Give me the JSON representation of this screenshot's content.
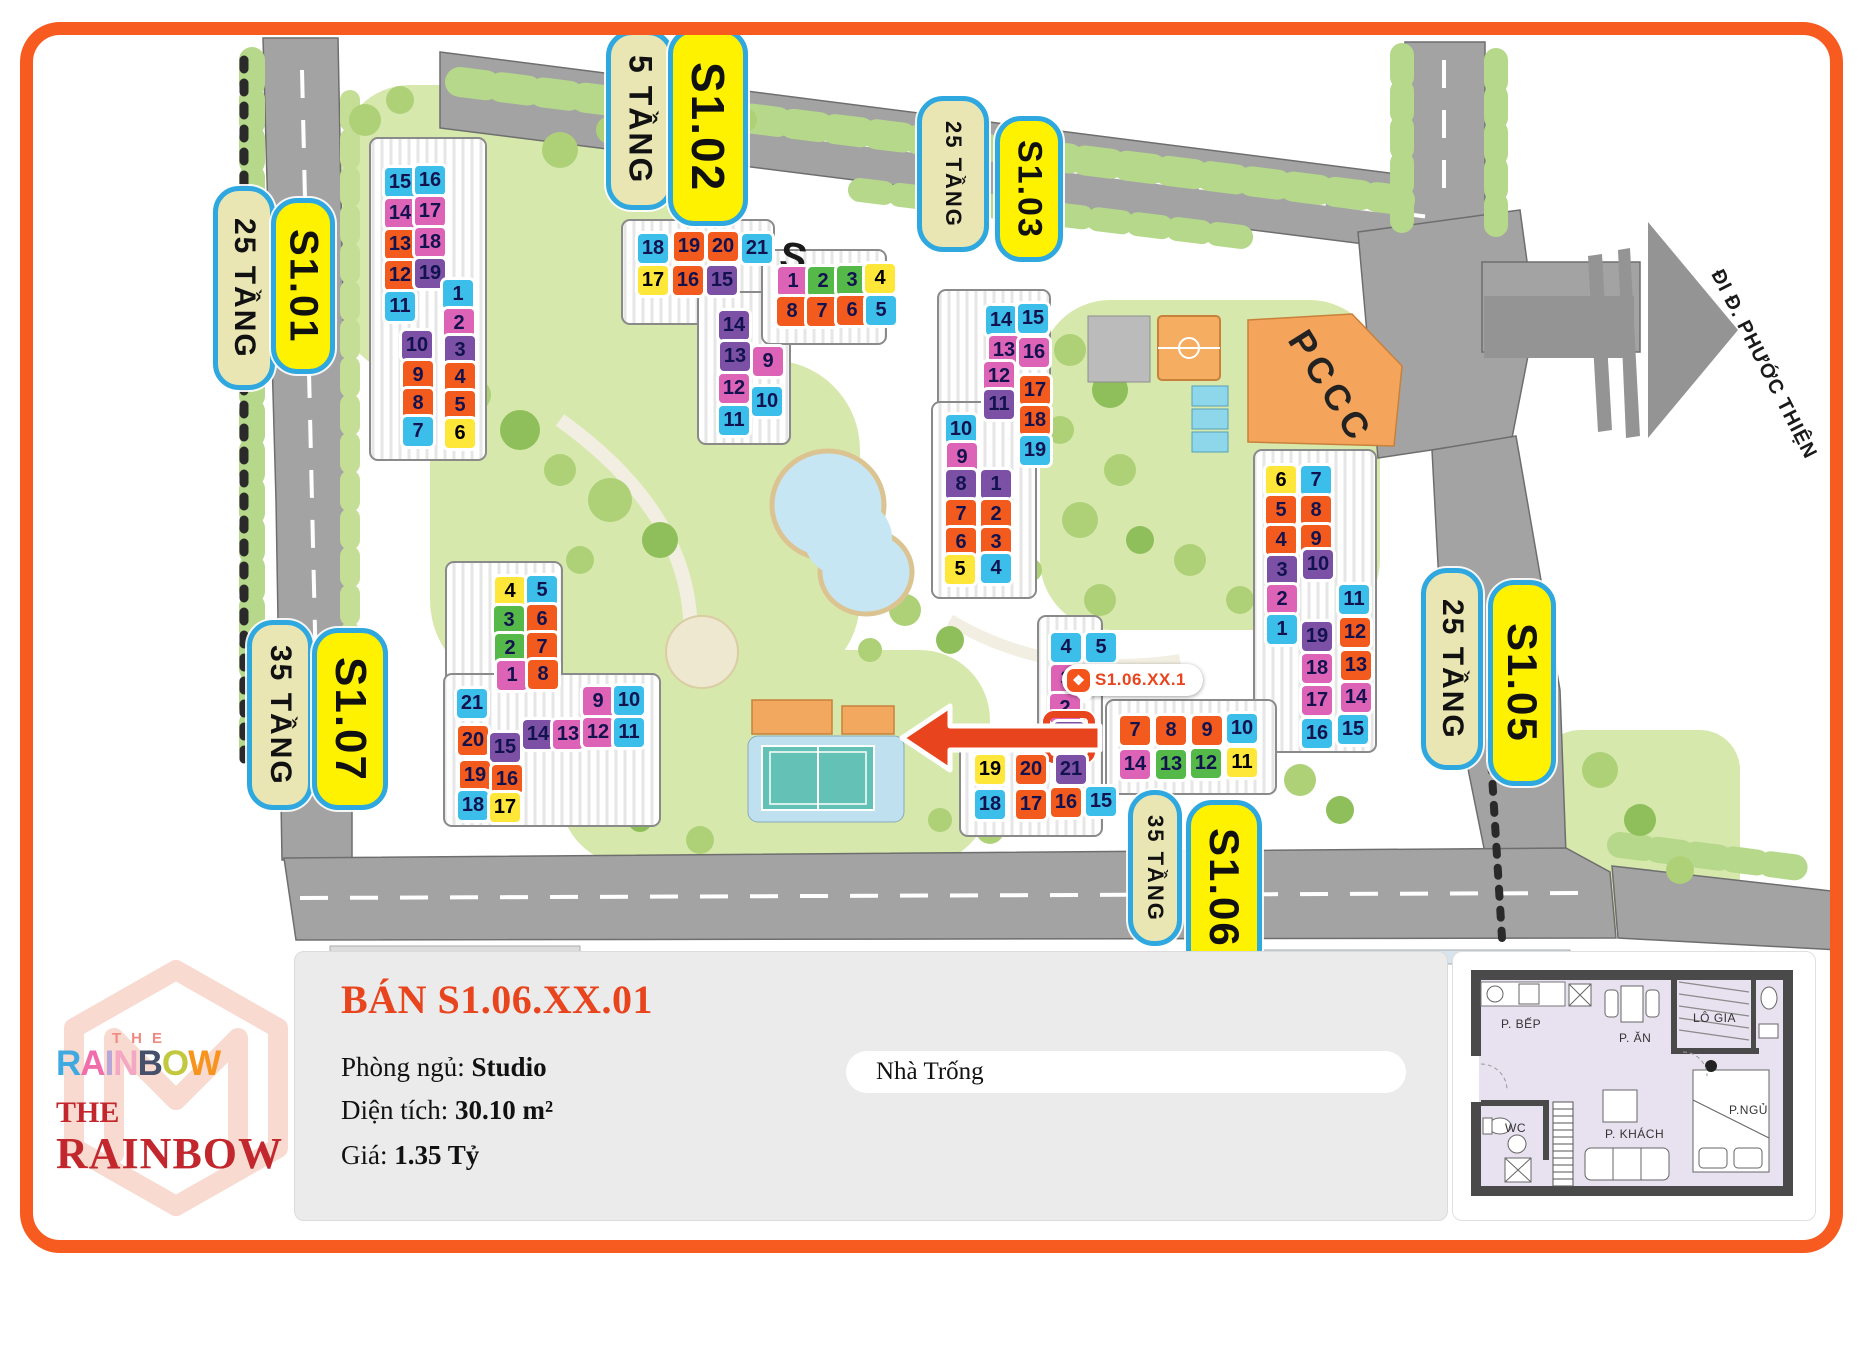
{
  "map": {
    "pccc_label": "PCCC",
    "road_sign": "ĐI Đ. PHƯỚC THIỆN",
    "stray_letter": "S",
    "tooltip": {
      "unit_code": "S1.06.XX.1",
      "icon": "diamond-logo"
    },
    "palette": {
      "cyan": "#3BBEEA",
      "magenta": "#DC63B6",
      "purple": "#7B50A5",
      "orange": "#F25A1E",
      "yellow": "#FFE73A",
      "green": "#54B948"
    },
    "labels": [
      {
        "name": "25tang-s101",
        "text": "25 TẦNG",
        "type": "tan",
        "x": 213,
        "y": 186,
        "w": 52,
        "h": 194,
        "fs": 30
      },
      {
        "name": "s101",
        "text": "S1.01",
        "type": "yel",
        "x": 271,
        "y": 198,
        "w": 54,
        "h": 166,
        "fs": 40
      },
      {
        "name": "5tang-s102",
        "text": "5 TẦNG",
        "type": "tan",
        "x": 606,
        "y": 30,
        "w": 58,
        "h": 170,
        "fs": 32
      },
      {
        "name": "s102",
        "text": "S1.02",
        "type": "yel",
        "x": 668,
        "y": 28,
        "w": 70,
        "h": 188,
        "fs": 46
      },
      {
        "name": "25tang-s103",
        "text": "25 TẦNG",
        "type": "tan",
        "x": 917,
        "y": 96,
        "w": 62,
        "h": 146,
        "fs": 22
      },
      {
        "name": "s103",
        "text": "S1.03",
        "type": "yel",
        "x": 995,
        "y": 116,
        "w": 58,
        "h": 136,
        "fs": 34
      },
      {
        "name": "25tang-s105",
        "text": "25 TẦNG",
        "type": "tan",
        "x": 1421,
        "y": 568,
        "w": 52,
        "h": 192,
        "fs": 30
      },
      {
        "name": "s105",
        "text": "S1.05",
        "type": "yel",
        "x": 1488,
        "y": 580,
        "w": 58,
        "h": 196,
        "fs": 42
      },
      {
        "name": "35tang-s107",
        "text": "35 TẦNG",
        "type": "tan",
        "x": 247,
        "y": 620,
        "w": 56,
        "h": 180,
        "fs": 30
      },
      {
        "name": "s107",
        "text": "S1.07",
        "type": "yel",
        "x": 312,
        "y": 628,
        "w": 66,
        "h": 172,
        "fs": 44
      },
      {
        "name": "35tang-s106",
        "text": "35 TẦNG",
        "type": "tan",
        "x": 1128,
        "y": 790,
        "w": 44,
        "h": 146,
        "fs": 22
      },
      {
        "name": "s106",
        "text": "S1.06",
        "type": "yel",
        "x": 1186,
        "y": 800,
        "w": 66,
        "h": 166,
        "fs": 42
      }
    ],
    "buildings": [
      {
        "id": "S1.01",
        "units": [
          {
            "n": "15",
            "c": "cyan",
            "x": 385,
            "y": 168
          },
          {
            "n": "16",
            "c": "cyan",
            "x": 415,
            "y": 166
          },
          {
            "n": "14",
            "c": "magenta",
            "x": 385,
            "y": 199
          },
          {
            "n": "17",
            "c": "magenta",
            "x": 415,
            "y": 197
          },
          {
            "n": "13",
            "c": "orange",
            "x": 385,
            "y": 230
          },
          {
            "n": "18",
            "c": "magenta",
            "x": 415,
            "y": 228
          },
          {
            "n": "12",
            "c": "orange",
            "x": 385,
            "y": 261
          },
          {
            "n": "19",
            "c": "purple",
            "x": 415,
            "y": 259
          },
          {
            "n": "11",
            "c": "cyan",
            "x": 385,
            "y": 292
          },
          {
            "n": "1",
            "c": "cyan",
            "x": 443,
            "y": 280
          },
          {
            "n": "2",
            "c": "magenta",
            "x": 444,
            "y": 309
          },
          {
            "n": "10",
            "c": "purple",
            "x": 402,
            "y": 331
          },
          {
            "n": "3",
            "c": "purple",
            "x": 445,
            "y": 336
          },
          {
            "n": "9",
            "c": "orange",
            "x": 403,
            "y": 361
          },
          {
            "n": "4",
            "c": "orange",
            "x": 445,
            "y": 363
          },
          {
            "n": "8",
            "c": "orange",
            "x": 403,
            "y": 389
          },
          {
            "n": "5",
            "c": "orange",
            "x": 445,
            "y": 391
          },
          {
            "n": "7",
            "c": "cyan",
            "x": 403,
            "y": 417
          },
          {
            "n": "6",
            "c": "yellow",
            "x": 445,
            "y": 419
          }
        ]
      },
      {
        "id": "S1.02",
        "units": [
          {
            "n": "18",
            "c": "cyan",
            "x": 638,
            "y": 234
          },
          {
            "n": "19",
            "c": "orange",
            "x": 674,
            "y": 232
          },
          {
            "n": "20",
            "c": "orange",
            "x": 708,
            "y": 232
          },
          {
            "n": "21",
            "c": "cyan",
            "x": 742,
            "y": 234
          },
          {
            "n": "17",
            "c": "yellow",
            "x": 638,
            "y": 266
          },
          {
            "n": "16",
            "c": "orange",
            "x": 673,
            "y": 266
          },
          {
            "n": "15",
            "c": "purple",
            "x": 707,
            "y": 266
          },
          {
            "n": "14",
            "c": "purple",
            "x": 719,
            "y": 311
          },
          {
            "n": "13",
            "c": "purple",
            "x": 720,
            "y": 342
          },
          {
            "n": "9",
            "c": "magenta",
            "x": 753,
            "y": 347
          },
          {
            "n": "12",
            "c": "magenta",
            "x": 719,
            "y": 374
          },
          {
            "n": "10",
            "c": "cyan",
            "x": 752,
            "y": 387
          },
          {
            "n": "11",
            "c": "cyan",
            "x": 719,
            "y": 406
          }
        ]
      },
      {
        "id": "S1.04",
        "units": [
          {
            "n": "1",
            "c": "magenta",
            "x": 778,
            "y": 267
          },
          {
            "n": "2",
            "c": "green",
            "x": 808,
            "y": 267
          },
          {
            "n": "3",
            "c": "green",
            "x": 837,
            "y": 266
          },
          {
            "n": "4",
            "c": "yellow",
            "x": 865,
            "y": 264
          },
          {
            "n": "8",
            "c": "orange",
            "x": 777,
            "y": 297
          },
          {
            "n": "7",
            "c": "orange",
            "x": 807,
            "y": 297
          },
          {
            "n": "6",
            "c": "orange",
            "x": 837,
            "y": 296
          },
          {
            "n": "5",
            "c": "cyan",
            "x": 866,
            "y": 296
          }
        ]
      },
      {
        "id": "S1.03",
        "units": [
          {
            "n": "14",
            "c": "cyan",
            "x": 986,
            "y": 306
          },
          {
            "n": "15",
            "c": "cyan",
            "x": 1018,
            "y": 304
          },
          {
            "n": "13",
            "c": "magenta",
            "x": 989,
            "y": 336
          },
          {
            "n": "16",
            "c": "magenta",
            "x": 1019,
            "y": 338
          },
          {
            "n": "12",
            "c": "magenta",
            "x": 984,
            "y": 362
          },
          {
            "n": "11",
            "c": "purple",
            "x": 984,
            "y": 390
          },
          {
            "n": "17",
            "c": "orange",
            "x": 1020,
            "y": 376
          },
          {
            "n": "18",
            "c": "orange",
            "x": 1020,
            "y": 406
          },
          {
            "n": "19",
            "c": "cyan",
            "x": 1020,
            "y": 436
          },
          {
            "n": "10",
            "c": "cyan",
            "x": 946,
            "y": 415
          },
          {
            "n": "9",
            "c": "magenta",
            "x": 947,
            "y": 443
          },
          {
            "n": "8",
            "c": "purple",
            "x": 946,
            "y": 470
          },
          {
            "n": "1",
            "c": "purple",
            "x": 981,
            "y": 470
          },
          {
            "n": "7",
            "c": "orange",
            "x": 946,
            "y": 500
          },
          {
            "n": "2",
            "c": "orange",
            "x": 981,
            "y": 500
          },
          {
            "n": "6",
            "c": "orange",
            "x": 946,
            "y": 528
          },
          {
            "n": "3",
            "c": "orange",
            "x": 981,
            "y": 528
          },
          {
            "n": "5",
            "c": "yellow",
            "x": 945,
            "y": 555
          },
          {
            "n": "4",
            "c": "cyan",
            "x": 981,
            "y": 554
          }
        ]
      },
      {
        "id": "S1.05",
        "units": [
          {
            "n": "6",
            "c": "yellow",
            "x": 1266,
            "y": 466
          },
          {
            "n": "7",
            "c": "cyan",
            "x": 1301,
            "y": 466
          },
          {
            "n": "5",
            "c": "orange",
            "x": 1266,
            "y": 496
          },
          {
            "n": "8",
            "c": "orange",
            "x": 1301,
            "y": 496
          },
          {
            "n": "4",
            "c": "orange",
            "x": 1266,
            "y": 526
          },
          {
            "n": "9",
            "c": "orange",
            "x": 1301,
            "y": 525
          },
          {
            "n": "3",
            "c": "purple",
            "x": 1267,
            "y": 556
          },
          {
            "n": "10",
            "c": "purple",
            "x": 1303,
            "y": 550
          },
          {
            "n": "2",
            "c": "magenta",
            "x": 1267,
            "y": 585
          },
          {
            "n": "11",
            "c": "cyan",
            "x": 1339,
            "y": 585
          },
          {
            "n": "1",
            "c": "cyan",
            "x": 1267,
            "y": 615
          },
          {
            "n": "19",
            "c": "purple",
            "x": 1302,
            "y": 622
          },
          {
            "n": "12",
            "c": "orange",
            "x": 1340,
            "y": 618
          },
          {
            "n": "18",
            "c": "magenta",
            "x": 1302,
            "y": 654
          },
          {
            "n": "13",
            "c": "orange",
            "x": 1341,
            "y": 651
          },
          {
            "n": "17",
            "c": "magenta",
            "x": 1302,
            "y": 686
          },
          {
            "n": "14",
            "c": "magenta",
            "x": 1341,
            "y": 683
          },
          {
            "n": "16",
            "c": "cyan",
            "x": 1302,
            "y": 719
          },
          {
            "n": "15",
            "c": "cyan",
            "x": 1338,
            "y": 715
          }
        ]
      },
      {
        "id": "S1.06",
        "units": [
          {
            "n": "4",
            "c": "cyan",
            "x": 1051,
            "y": 633
          },
          {
            "n": "5",
            "c": "cyan",
            "x": 1086,
            "y": 633
          },
          {
            "n": "3",
            "c": "magenta",
            "x": 1051,
            "y": 665
          },
          {
            "n": "2",
            "c": "magenta",
            "x": 1050,
            "y": 694
          },
          {
            "n": "1",
            "c": "purple",
            "x": 1054,
            "y": 722,
            "hl": true
          },
          {
            "n": "7",
            "c": "orange",
            "x": 1120,
            "y": 716
          },
          {
            "n": "8",
            "c": "orange",
            "x": 1156,
            "y": 716
          },
          {
            "n": "9",
            "c": "orange",
            "x": 1192,
            "y": 716
          },
          {
            "n": "10",
            "c": "cyan",
            "x": 1227,
            "y": 714
          },
          {
            "n": "14",
            "c": "magenta",
            "x": 1120,
            "y": 750
          },
          {
            "n": "13",
            "c": "green",
            "x": 1156,
            "y": 750
          },
          {
            "n": "12",
            "c": "green",
            "x": 1191,
            "y": 749
          },
          {
            "n": "11",
            "c": "yellow",
            "x": 1227,
            "y": 748
          },
          {
            "n": "19",
            "c": "yellow",
            "x": 975,
            "y": 755
          },
          {
            "n": "20",
            "c": "orange",
            "x": 1016,
            "y": 755
          },
          {
            "n": "21",
            "c": "purple",
            "x": 1056,
            "y": 755
          },
          {
            "n": "18",
            "c": "cyan",
            "x": 975,
            "y": 790
          },
          {
            "n": "17",
            "c": "orange",
            "x": 1016,
            "y": 790
          },
          {
            "n": "16",
            "c": "orange",
            "x": 1051,
            "y": 788
          },
          {
            "n": "15",
            "c": "cyan",
            "x": 1086,
            "y": 787
          }
        ]
      },
      {
        "id": "S1.07",
        "units": [
          {
            "n": "4",
            "c": "yellow",
            "x": 495,
            "y": 577
          },
          {
            "n": "5",
            "c": "cyan",
            "x": 527,
            "y": 576
          },
          {
            "n": "3",
            "c": "green",
            "x": 494,
            "y": 606
          },
          {
            "n": "6",
            "c": "orange",
            "x": 527,
            "y": 605
          },
          {
            "n": "2",
            "c": "green",
            "x": 495,
            "y": 634
          },
          {
            "n": "7",
            "c": "orange",
            "x": 527,
            "y": 633
          },
          {
            "n": "1",
            "c": "magenta",
            "x": 497,
            "y": 661
          },
          {
            "n": "8",
            "c": "orange",
            "x": 528,
            "y": 660
          },
          {
            "n": "21",
            "c": "cyan",
            "x": 457,
            "y": 689
          },
          {
            "n": "9",
            "c": "magenta",
            "x": 583,
            "y": 687
          },
          {
            "n": "10",
            "c": "cyan",
            "x": 614,
            "y": 686
          },
          {
            "n": "20",
            "c": "orange",
            "x": 458,
            "y": 726
          },
          {
            "n": "15",
            "c": "purple",
            "x": 490,
            "y": 733
          },
          {
            "n": "14",
            "c": "purple",
            "x": 523,
            "y": 720
          },
          {
            "n": "13",
            "c": "magenta",
            "x": 553,
            "y": 720
          },
          {
            "n": "12",
            "c": "magenta",
            "x": 583,
            "y": 718
          },
          {
            "n": "11",
            "c": "cyan",
            "x": 614,
            "y": 718
          },
          {
            "n": "19",
            "c": "orange",
            "x": 460,
            "y": 761
          },
          {
            "n": "16",
            "c": "orange",
            "x": 492,
            "y": 765
          },
          {
            "n": "18",
            "c": "cyan",
            "x": 458,
            "y": 791
          },
          {
            "n": "17",
            "c": "yellow",
            "x": 490,
            "y": 793
          }
        ]
      }
    ]
  },
  "info_panel": {
    "title": "BÁN S1.06.XX.01",
    "bedroom_label": "Phòng ngủ:",
    "bedroom_value": "Studio",
    "area_label": "Diện tích:",
    "area_value": "30.10 m²",
    "price_label": "Giá:",
    "price_value": "1.35 Tỷ",
    "status": "Nhà Trống"
  },
  "logo": {
    "the_top": "THE",
    "rainbow_letters": [
      {
        "ch": "R",
        "color": "#3FA9E0"
      },
      {
        "ch": "A",
        "color": "#F06EAC"
      },
      {
        "ch": "I",
        "color": "#B9A6D8"
      },
      {
        "ch": "N",
        "color": "#F4A7C3"
      },
      {
        "ch": "B",
        "color": "#46506B"
      },
      {
        "ch": "O",
        "color": "#C2C93E"
      },
      {
        "ch": "W",
        "color": "#F7941E"
      }
    ],
    "the_bottom": "THE",
    "rainbow_bottom": "RAINBOW"
  },
  "floorplan": {
    "rooms": [
      "P. BẾP",
      "P. ĂN",
      "LÔ GIA",
      "WC",
      "P. KHÁCH",
      "P.NGỦ"
    ]
  }
}
